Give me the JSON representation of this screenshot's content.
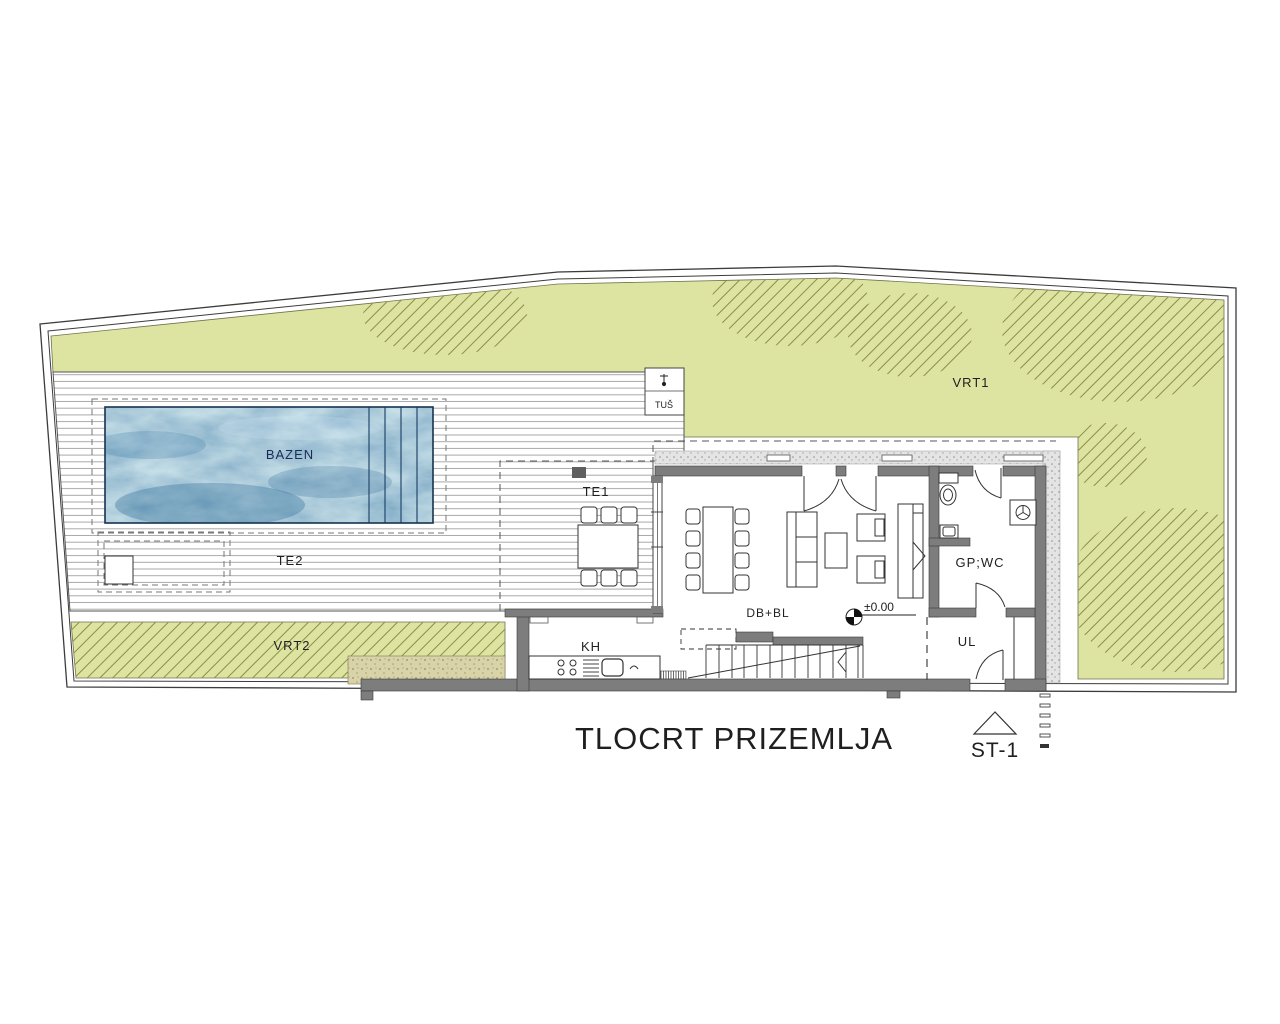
{
  "drawing": {
    "title": "TLOCRT PRIZEMLJA",
    "stair_marker": "ST-1",
    "elevation": "±0.00",
    "rooms": {
      "pool": "BAZEN",
      "terrace_1": "TE1",
      "terrace_2": "TE2",
      "garden_1": "VRT1",
      "garden_2": "VRT2",
      "shower": "TUŠ",
      "kitchen": "KH",
      "dining_living": "DB+BL",
      "wc": "GP;WC",
      "entry": "UL"
    },
    "colors": {
      "garden": "#dde3a1",
      "hatch": "#8e8e44",
      "pool_water": "#5b9cc6",
      "wall": "#7d7d7d",
      "sand": "#d9d3a9",
      "paper": "#ffffff"
    }
  }
}
